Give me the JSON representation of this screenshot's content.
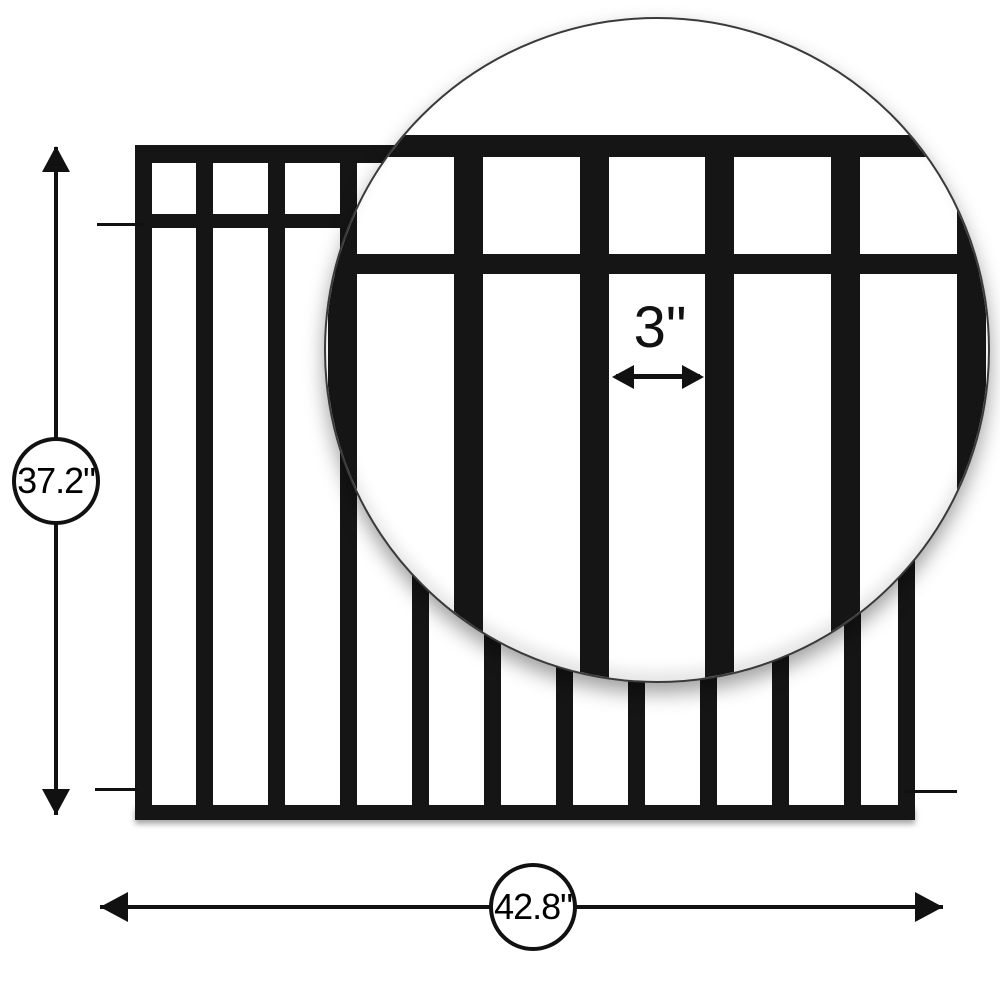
{
  "diagram": {
    "type": "product-dimension-diagram",
    "subject": "black metal fence panel with vertical pickets, two upper rails, one bottom rail, and a magnifying-glass inset showing picket spacing",
    "dimensions": {
      "height": {
        "label": "37.2\""
      },
      "width": {
        "label": "42.8\""
      },
      "picket_spacing": {
        "label": "3\""
      }
    },
    "colors": {
      "background": "#ffffff",
      "fence": "#151515",
      "dimension_ink": "#111111",
      "lens_border": "#3a3a3a"
    },
    "geometry": {
      "fence": {
        "bar_width": 17,
        "uprights_x": [
          0,
          61,
          133,
          205,
          277,
          349,
          421,
          493,
          565,
          637,
          709,
          763
        ],
        "rails": [
          {
            "y": 0,
            "h": 18
          },
          {
            "y": 69,
            "h": 14
          },
          {
            "y": 660,
            "h": 15,
            "bottom": true
          }
        ]
      },
      "magnifier": {
        "rails": [
          {
            "y": 116,
            "h": 22
          },
          {
            "y": 235,
            "h": 20
          }
        ],
        "bars_top": 116,
        "bar_width": 29,
        "bars_x": [
          2,
          128,
          254,
          379,
          505,
          631
        ]
      }
    }
  }
}
